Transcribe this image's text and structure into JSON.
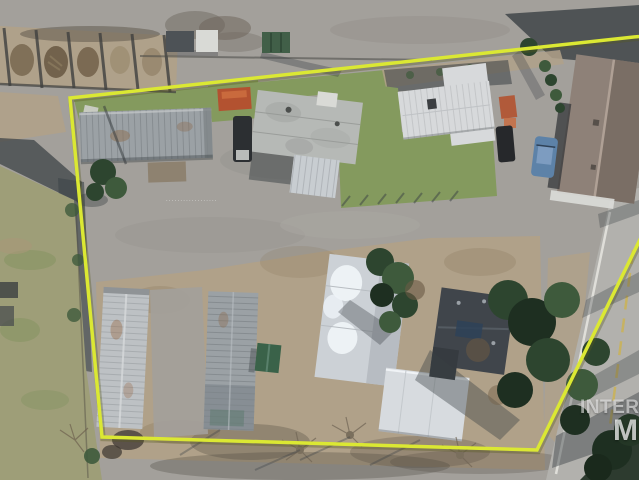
{
  "image": {
    "kind": "aerial-drone-photo",
    "subject": "Overhead winter aerial view of a mobile home park parcel with buildings, parking areas, trees and an adjacent road",
    "width_px": 639,
    "height_px": 480
  },
  "boundary": {
    "label": "property-boundary",
    "color": "#dbe833",
    "points": "70,98 745,25 537,450 102,437"
  },
  "watermark": {
    "line1": "INTERMOUNTAIN",
    "line2": "MLS",
    "note_visible_part": "INTER / M clipped at right edge"
  },
  "parcel_label": "··················",
  "road": {
    "center_line_color": "#c9b25a",
    "edge_line_color": "#e6e6e0"
  },
  "objects": {
    "buildings": [
      "trailer-north",
      "trailer-center-mottled",
      "building-white-cross",
      "house-brown-roof",
      "trailer-west-long",
      "trailer-center-long",
      "green-shed",
      "building-snow-roof",
      "carport-white",
      "building-dark-roof"
    ],
    "vehicles": [
      "dark-van",
      "dark-suv",
      "blue-car"
    ],
    "site_features": [
      "storage-bays",
      "orange-dumpster",
      "green-dumpster",
      "white-shed",
      "evergreen-trees",
      "bare-winter-trees",
      "road-east"
    ]
  },
  "palette": {
    "pavement": "#a3a09b",
    "pavementDark": "#908d88",
    "road": "#b2b1ad",
    "roadYellow": "#c9b25a",
    "roadEdge": "#e6e6e0",
    "dirt": "#b0a189",
    "dirtDark": "#857357",
    "grass": "#849a5e",
    "grassOlive": "#9e9e78",
    "grassDark": "#6f8a4e",
    "treeDark": "#2d452f",
    "treeMid": "#3e5a3c",
    "treeDeep": "#1e2f21",
    "shadow": "#3a4044",
    "roofSilver": "#9ba1a5",
    "roofMottled": "#b6b9b6",
    "roofWhite": "#d7d9db",
    "trailerWhite": "#bdc1c4",
    "houseRoof": "#8e8178",
    "houseRoofDark": "#7a6e65",
    "houseRidge": "#b3a499",
    "roofDark": "#40454b",
    "shedGreen": "#3a6249",
    "dumpsterOrange": "#b35230",
    "carBlue": "#5d82a8",
    "tarpBlue": "#2e4258",
    "boundary": "#dbe833",
    "boundaryShadow": "#565a1e"
  }
}
